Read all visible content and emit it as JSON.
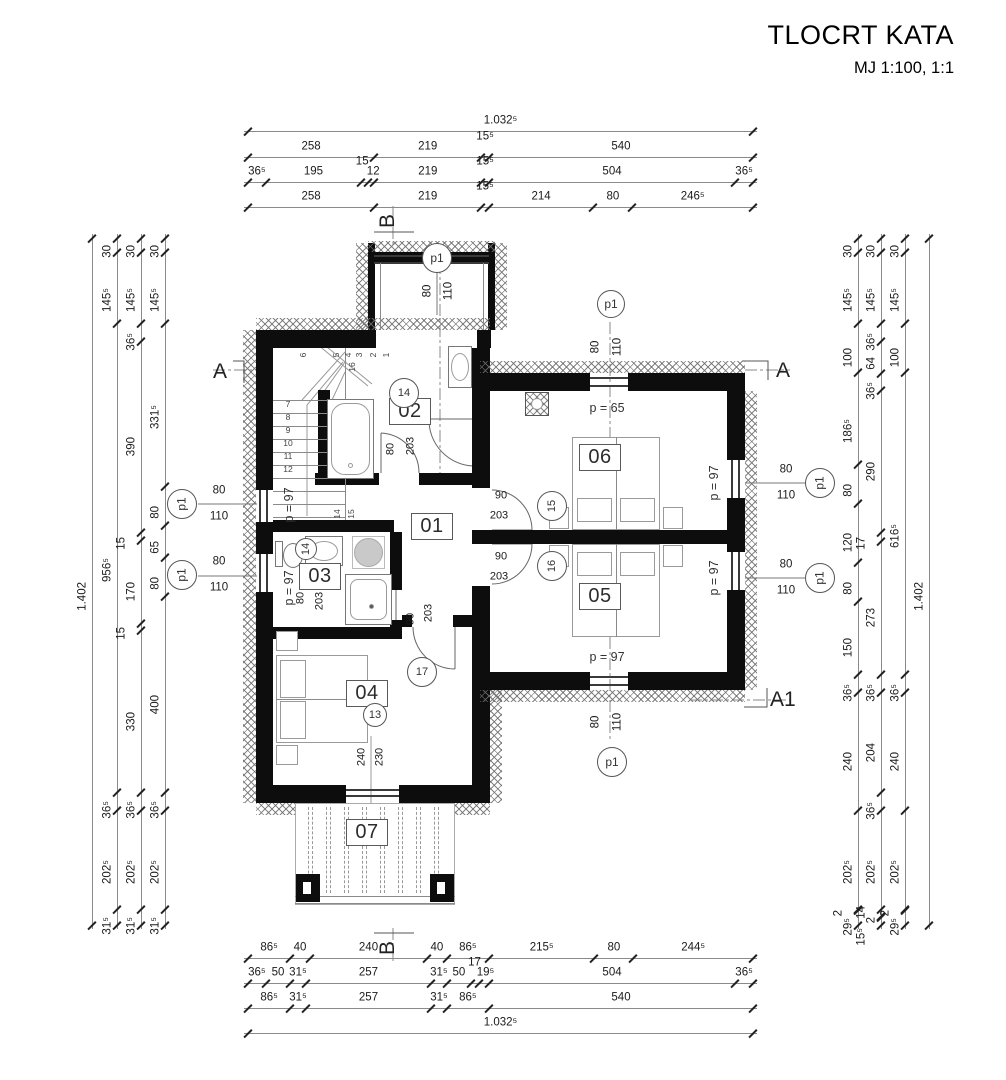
{
  "title": {
    "main": "TLOCRT KATA",
    "scale": "MJ 1:100, 1:1"
  },
  "section_markers": {
    "a": "A",
    "a1": "A1",
    "b": "B"
  },
  "rooms": [
    {
      "id": "01",
      "label": "01"
    },
    {
      "id": "02",
      "label": "02"
    },
    {
      "id": "03",
      "label": "03"
    },
    {
      "id": "04",
      "label": "04"
    },
    {
      "id": "05",
      "label": "05"
    },
    {
      "id": "06",
      "label": "06"
    },
    {
      "id": "07",
      "label": "07"
    }
  ],
  "opening_markers": [
    {
      "id": "13",
      "label": "13"
    },
    {
      "id": "14",
      "label": "14"
    },
    {
      "id": "14b",
      "label": "14"
    },
    {
      "id": "15",
      "label": "15"
    },
    {
      "id": "16",
      "label": "16"
    },
    {
      "id": "17",
      "label": "17"
    }
  ],
  "window_type_label": "p1",
  "window_size": {
    "width": "80",
    "height": "110"
  },
  "door_labels": [
    {
      "id": "door-02",
      "width": "80",
      "height": "203"
    },
    {
      "id": "door-03",
      "width": "80",
      "height": "203"
    },
    {
      "id": "door-04",
      "width": "90",
      "height": "203"
    },
    {
      "id": "door-06",
      "width": "90",
      "height": "203"
    },
    {
      "id": "door-05",
      "width": "90",
      "height": "203"
    },
    {
      "id": "balcony-door",
      "width": "240",
      "height": "230"
    }
  ],
  "parapet_labels": [
    {
      "id": "p65",
      "text": "p = 65"
    },
    {
      "id": "p97-bottom",
      "text": "p = 97"
    },
    {
      "id": "p97-right-upper",
      "text": "p = 97"
    },
    {
      "id": "p97-right-lower",
      "text": "p = 97"
    },
    {
      "id": "p97-stairs",
      "text": "p = 97"
    },
    {
      "id": "p97-bath",
      "text": "p = 97"
    }
  ],
  "stairs": {
    "left_treads": [
      "7",
      "8",
      "9",
      "10",
      "11",
      "12"
    ],
    "top_treads": [
      "6",
      "5",
      "4",
      "3",
      "2",
      "1"
    ],
    "mid_treads": [
      "14",
      "15"
    ],
    "break_tread": "16"
  },
  "dim_chains": {
    "top": [
      {
        "name": "top-total",
        "values": [
          "1.032⁵"
        ]
      },
      {
        "name": "top-main",
        "values": [
          "258",
          "219",
          "15⁵",
          "540"
        ]
      },
      {
        "name": "top-detail",
        "values": [
          "36⁵",
          "195",
          "15",
          "12",
          "219",
          "15⁵",
          "504",
          "36⁵"
        ]
      },
      {
        "name": "top-openings",
        "values": [
          "258",
          "219",
          "15⁵",
          "214",
          "80",
          "246⁵"
        ]
      }
    ],
    "bottom": [
      {
        "name": "bottom-openings",
        "values": [
          "86⁵",
          "40",
          "240",
          "40",
          "86⁵",
          "215⁵",
          "80",
          "244⁵"
        ]
      },
      {
        "name": "bottom-detail",
        "values": [
          "36⁵",
          "50",
          "31⁵",
          "257",
          "31⁵",
          "50",
          "17",
          "19⁵",
          "504",
          "36⁵"
        ]
      },
      {
        "name": "bottom-main",
        "values": [
          "86⁵",
          "31⁵",
          "257",
          "31⁵",
          "86⁵",
          "540"
        ]
      },
      {
        "name": "bottom-total",
        "values": [
          "1.032⁵"
        ]
      }
    ],
    "left": [
      {
        "name": "left-total",
        "values": [
          "1.402"
        ]
      },
      {
        "name": "left-main",
        "values": [
          "30",
          "145⁵",
          "956⁵",
          "36⁵",
          "202⁵",
          "31⁵"
        ]
      },
      {
        "name": "left-detail",
        "values": [
          "30",
          "145⁵",
          "36⁵",
          "390",
          "15",
          "170",
          "15",
          "330",
          "36⁵",
          "202⁵",
          "31⁵"
        ]
      },
      {
        "name": "left-openings",
        "values": [
          "30",
          "145⁵",
          "331⁵",
          "80",
          "65",
          "80",
          "400",
          "36⁵",
          "202⁵",
          "31⁵"
        ]
      }
    ],
    "right": [
      {
        "name": "right-openings",
        "values": [
          "30",
          "145⁵",
          "100",
          "186⁵",
          "80",
          "120",
          "80",
          "150",
          "36⁵",
          "240",
          "202⁵",
          "2",
          "29⁵"
        ]
      },
      {
        "name": "right-detail",
        "values": [
          "30",
          "145⁵",
          "36⁵",
          "64",
          "36⁵",
          "290",
          "17",
          "273",
          "36⁵",
          "204",
          "36⁵",
          "202⁵",
          "14",
          "2",
          "15⁵"
        ]
      },
      {
        "name": "right-main",
        "values": [
          "30",
          "145⁵",
          "100",
          "616⁵",
          "36⁵",
          "240",
          "202⁵",
          "2",
          "29⁵"
        ]
      },
      {
        "name": "right-total",
        "values": [
          "1.402"
        ]
      }
    ]
  }
}
